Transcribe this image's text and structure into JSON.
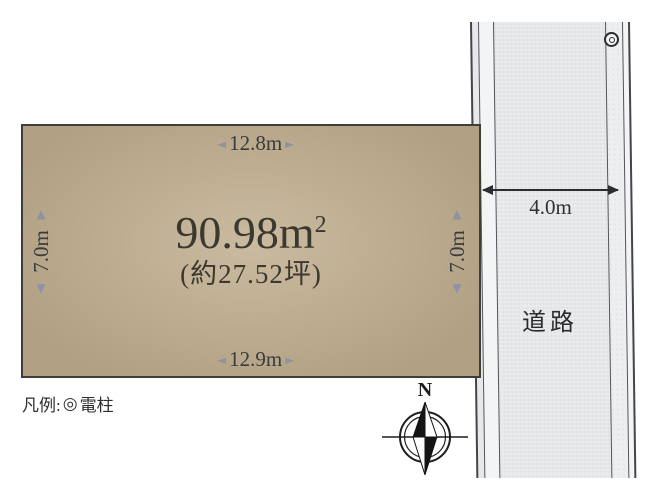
{
  "plot": {
    "area_value": "90.98m",
    "area_exponent": "2",
    "area_tsubo": "(約27.52坪)",
    "width_top": "12.8m",
    "width_bottom": "12.9m",
    "depth_left": "7.0m",
    "depth_right": "7.0m"
  },
  "road": {
    "name": "道路",
    "width": "4.0m"
  },
  "legend": {
    "prefix": "凡例:",
    "symbol": "◎",
    "item": "電柱"
  },
  "compass": {
    "north": "N"
  },
  "icons": {
    "arrow_left": "◄",
    "arrow_right": "►",
    "arrow_up": "▲",
    "arrow_down": "▼"
  },
  "colors": {
    "plot_fill": "#bdac8f",
    "plot_fill_center": "#cabaa0",
    "plot_border": "#403e38",
    "road_surface": "#e8eaec",
    "road_line": "#54555b",
    "dimension_text": "#3a3b3f",
    "dimension_arrow": "#8d93a2",
    "measure_line": "#2c2d31",
    "text_dark": "#2b2b2b"
  }
}
